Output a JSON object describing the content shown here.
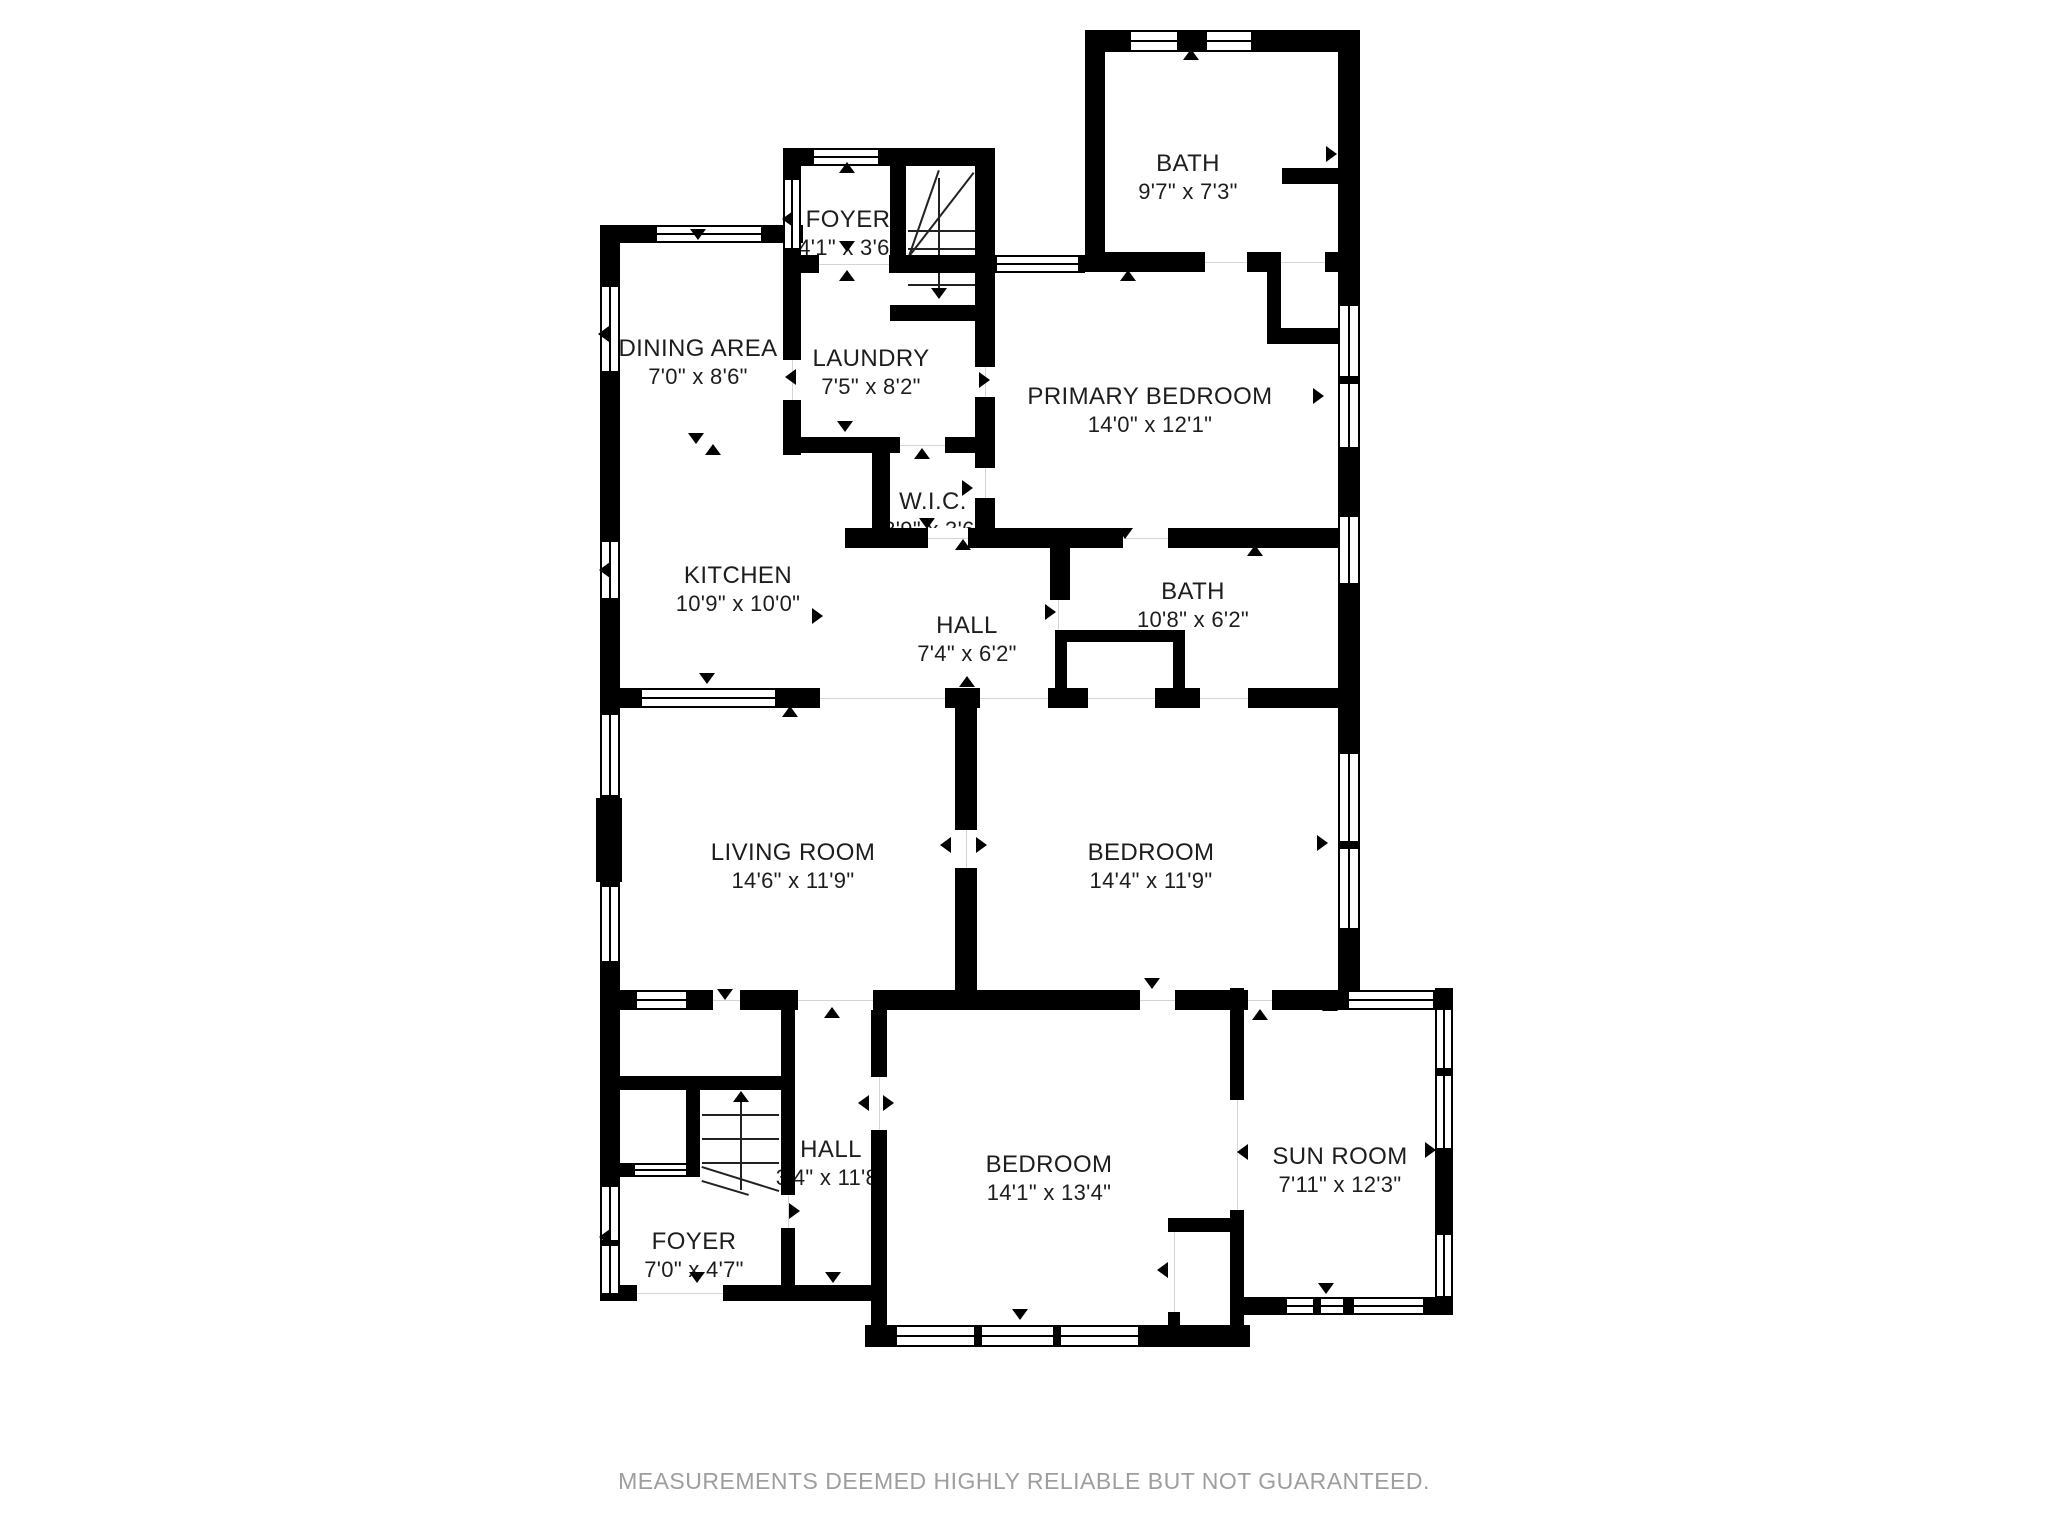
{
  "page": {
    "background": "#ffffff",
    "wall_color": "#000000",
    "label_color": "#1d1d1d"
  },
  "rooms": [
    {
      "id": "foyer-upper",
      "name": "FOYER",
      "dims": "4'1\" x 3'6\""
    },
    {
      "id": "bath-upper",
      "name": "BATH",
      "dims": "9'7\" x 7'3\""
    },
    {
      "id": "dining-area",
      "name": "DINING AREA",
      "dims": "7'0\" x 8'6\""
    },
    {
      "id": "laundry",
      "name": "LAUNDRY",
      "dims": "7'5\" x 8'2\""
    },
    {
      "id": "primary-bedroom",
      "name": "PRIMARY BEDROOM",
      "dims": "14'0\" x 12'1\""
    },
    {
      "id": "wic",
      "name": "W.I.C.",
      "dims": "3'9\" x 3'6\""
    },
    {
      "id": "kitchen",
      "name": "KITCHEN",
      "dims": "10'9\" x 10'0\""
    },
    {
      "id": "hall-middle",
      "name": "HALL",
      "dims": "7'4\" x 6'2\""
    },
    {
      "id": "bath-middle",
      "name": "BATH",
      "dims": "10'8\" x 6'2\""
    },
    {
      "id": "living-room",
      "name": "LIVING ROOM",
      "dims": "14'6\" x 11'9\""
    },
    {
      "id": "bedroom-middle",
      "name": "BEDROOM",
      "dims": "14'4\" x 11'9\""
    },
    {
      "id": "hall-lower",
      "name": "HALL",
      "dims": "3'4\" x 11'8\""
    },
    {
      "id": "foyer-lower",
      "name": "FOYER",
      "dims": "7'0\" x 4'7\""
    },
    {
      "id": "bedroom-lower",
      "name": "BEDROOM",
      "dims": "14'1\" x 13'4\""
    },
    {
      "id": "sun-room",
      "name": "SUN ROOM",
      "dims": "7'11\" x 12'3\""
    }
  ],
  "footer": {
    "text": "MEASUREMENTS DEEMED HIGHLY RELIABLE BUT NOT GUARANTEED.",
    "color": "#9e9e9e"
  }
}
